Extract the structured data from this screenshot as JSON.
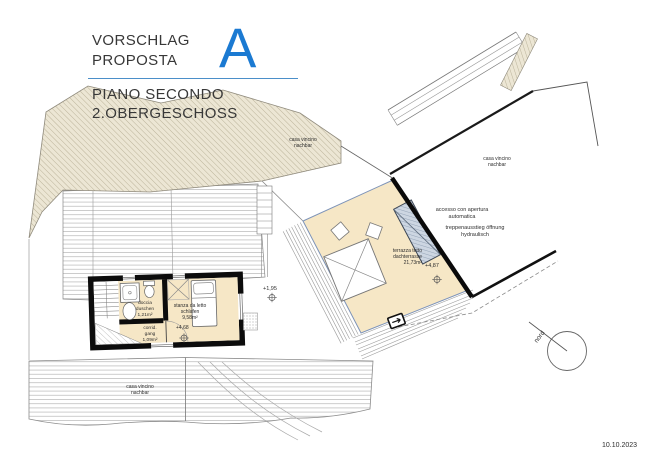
{
  "title_block": {
    "proposal_de": "VORSCHLAG",
    "proposal_it": "PROPOSTA",
    "variant": "A",
    "floor_it": "PIANO SECONDO",
    "floor_de": "2.OBERGESCHOSS"
  },
  "neighbors": {
    "top_left": {
      "l1": "casa vincino",
      "l2": "nachbar"
    },
    "top_right": {
      "l1": "casa vincino",
      "l2": "nachbar"
    },
    "bottom": {
      "l1": "casa vincino",
      "l2": "nachbar"
    }
  },
  "annotations": {
    "access": {
      "l1": "accesso con apertura",
      "l2": "automatica"
    },
    "stair_exit": {
      "l1": "treppenausstieg öffnung",
      "l2": "hydraulisch"
    },
    "level_terrace": "+4,87",
    "level_mid": "+1,95",
    "level_bedroom": "+4,68",
    "north": "nord",
    "date": "10.10.2023"
  },
  "rooms": {
    "terrace": {
      "l1": "terrazza tetto",
      "l2": "dachterrasse",
      "area": "21,73m²"
    },
    "bedroom": {
      "l1": "stanza da letto",
      "l2": "schlafen",
      "area": "9,58m²"
    },
    "shower": {
      "l1": "doccia",
      "l2": "duschen",
      "area": "1,21m²"
    },
    "corridor": {
      "l1": "corrid.",
      "l2": "gang",
      "area": "1,09m²"
    }
  },
  "colors": {
    "accent_blue": "#1b7ad2",
    "floor_cream": "#f6e7c6",
    "hatch_beige": "#ece6d4",
    "stair_hatch_blue": "#cdd6e2",
    "wall_black": "#0c0c0c"
  }
}
